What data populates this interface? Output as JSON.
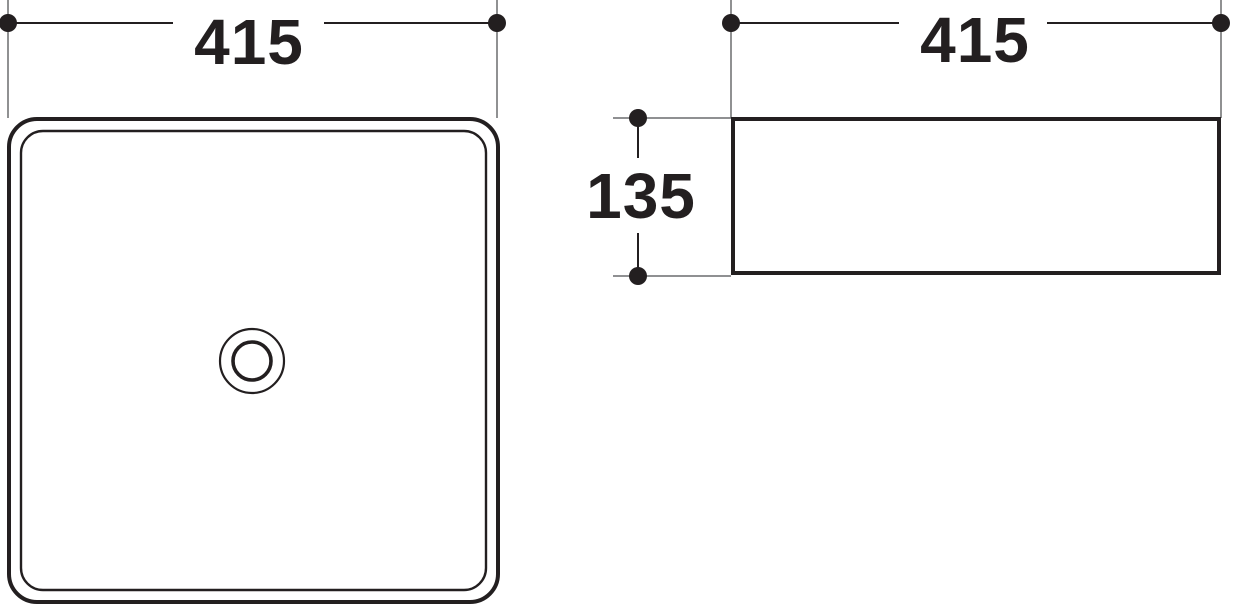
{
  "drawing": {
    "top_view": {
      "width_label": "415"
    },
    "side_view": {
      "width_label": "415",
      "height_label": "135"
    },
    "colors": {
      "line": "#231f20",
      "extension_line": "#6a6c6e",
      "background": "#ffffff"
    }
  }
}
